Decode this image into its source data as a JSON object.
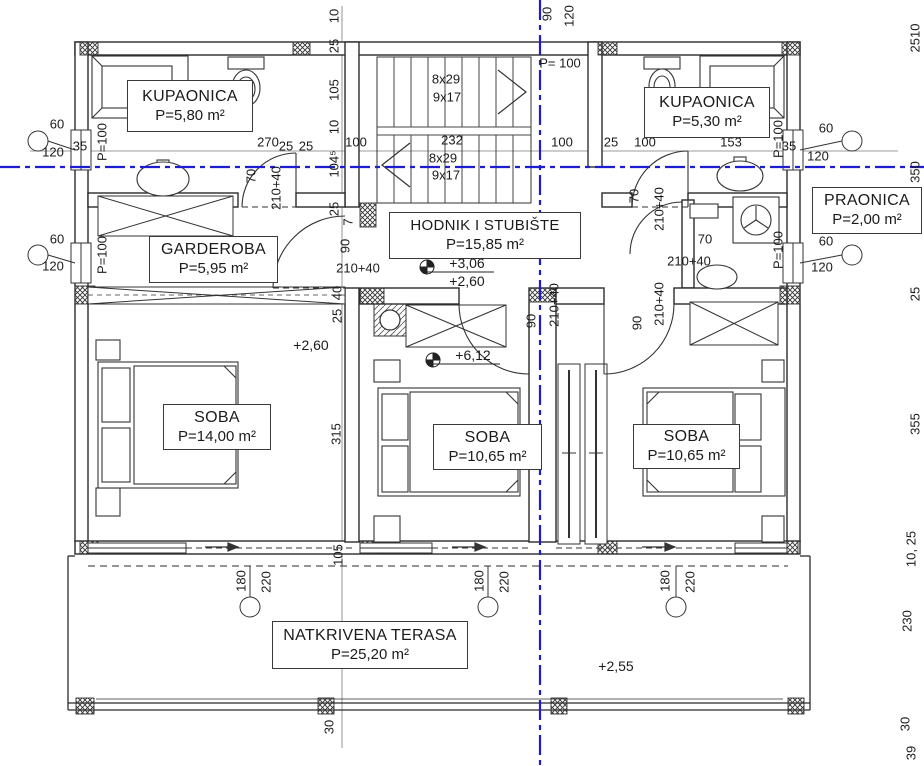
{
  "rooms": {
    "kupaonica_left": {
      "name": "KUPAONICA",
      "area": "P=5,80 m²"
    },
    "kupaonica_right": {
      "name": "KUPAONICA",
      "area": "P=5,30 m²"
    },
    "praonica": {
      "name": "PRAONICA",
      "area": "P=2,00 m²"
    },
    "garderoba": {
      "name": "GARDEROBA",
      "area": "P=5,95 m²"
    },
    "hodnik": {
      "name": "HODNIK I STUBIŠTE",
      "area": "P=15,85 m²"
    },
    "soba_left": {
      "name": "SOBA",
      "area": "P=14,00 m²"
    },
    "soba_middle": {
      "name": "SOBA",
      "area": "P=10,65 m²"
    },
    "soba_right": {
      "name": "SOBA",
      "area": "P=10,65 m²"
    },
    "terasa": {
      "name": "NATKRIVENA TERASA",
      "area": "P=25,20 m²"
    }
  },
  "levels": {
    "hall_upper": "+3,06",
    "hall_lower": "+2,60",
    "stair_top": "+6,12",
    "room_left": "+2,60",
    "terrace": "+2,55"
  },
  "stairs": {
    "upper_l1": "8x29",
    "upper_l2": "9x17",
    "lower_l1": "8x29",
    "lower_l2": "9x17"
  },
  "axis_color": "#1c1cd0",
  "dims": [
    {
      "t": "60",
      "x": 57,
      "y": 124,
      "r": 0
    },
    {
      "t": "120",
      "x": 53,
      "y": 152,
      "r": 0
    },
    {
      "t": "35",
      "x": 80,
      "y": 146,
      "r": 0
    },
    {
      "t": "270",
      "x": 268,
      "y": 142,
      "r": 0
    },
    {
      "t": "25",
      "x": 286,
      "y": 146,
      "r": 0
    },
    {
      "t": "25",
      "x": 306,
      "y": 146,
      "r": 0
    },
    {
      "t": "100",
      "x": 356,
      "y": 142,
      "r": 0
    },
    {
      "t": "232",
      "x": 452,
      "y": 140,
      "r": 0
    },
    {
      "t": "100",
      "x": 562,
      "y": 142,
      "r": 0
    },
    {
      "t": "25",
      "x": 611,
      "y": 142,
      "r": 0
    },
    {
      "t": "100",
      "x": 645,
      "y": 142,
      "r": 0
    },
    {
      "t": "153",
      "x": 731,
      "y": 142,
      "r": 0
    },
    {
      "t": "35",
      "x": 789,
      "y": 146,
      "r": 0
    },
    {
      "t": "120",
      "x": 818,
      "y": 156,
      "r": 0
    },
    {
      "t": "60",
      "x": 826,
      "y": 128,
      "r": 0
    },
    {
      "t": "60",
      "x": 57,
      "y": 239,
      "r": 0
    },
    {
      "t": "120",
      "x": 53,
      "y": 266,
      "r": 0
    },
    {
      "t": "60",
      "x": 826,
      "y": 241,
      "r": 0
    },
    {
      "t": "120",
      "x": 822,
      "y": 267,
      "r": 0
    },
    {
      "t": "10",
      "x": 334,
      "y": 16,
      "r": 1
    },
    {
      "t": "25",
      "x": 334,
      "y": 46,
      "r": 1
    },
    {
      "t": "105",
      "x": 334,
      "y": 90,
      "r": 1
    },
    {
      "t": "10",
      "x": 334,
      "y": 127,
      "r": 1
    },
    {
      "t": "104⁵",
      "x": 334,
      "y": 164,
      "r": 1
    },
    {
      "t": "25",
      "x": 334,
      "y": 209,
      "r": 1
    },
    {
      "t": "7",
      "x": 348,
      "y": 222,
      "r": 1
    },
    {
      "t": "90",
      "x": 547,
      "y": 14,
      "r": 1
    },
    {
      "t": "120",
      "x": 569,
      "y": 16,
      "r": 1
    },
    {
      "t": "P= 100",
      "x": 560,
      "y": 63,
      "r": 0
    },
    {
      "t": "P=100",
      "x": 102,
      "y": 142,
      "r": 1
    },
    {
      "t": "P=100",
      "x": 102,
      "y": 255,
      "r": 1
    },
    {
      "t": "P=100",
      "x": 778,
      "y": 139,
      "r": 1
    },
    {
      "t": "P=100",
      "x": 778,
      "y": 250,
      "r": 1
    },
    {
      "t": "70",
      "x": 251,
      "y": 176,
      "r": 1
    },
    {
      "t": "210+40",
      "x": 276,
      "y": 188,
      "r": 1
    },
    {
      "t": "70",
      "x": 634,
      "y": 196,
      "r": 1
    },
    {
      "t": "210+40",
      "x": 659,
      "y": 209,
      "r": 1
    },
    {
      "t": "70",
      "x": 705,
      "y": 239,
      "r": 0
    },
    {
      "t": "210+40",
      "x": 689,
      "y": 261,
      "r": 0
    },
    {
      "t": "90",
      "x": 345,
      "y": 246,
      "r": 1
    },
    {
      "t": "210+40",
      "x": 358,
      "y": 268,
      "r": 0
    },
    {
      "t": "40",
      "x": 337,
      "y": 293,
      "r": 1
    },
    {
      "t": "25",
      "x": 337,
      "y": 316,
      "r": 1
    },
    {
      "t": "90",
      "x": 531,
      "y": 321,
      "r": 1
    },
    {
      "t": "210+40",
      "x": 554,
      "y": 305,
      "r": 1
    },
    {
      "t": "90",
      "x": 637,
      "y": 323,
      "r": 1
    },
    {
      "t": "210+40",
      "x": 659,
      "y": 304,
      "r": 1
    },
    {
      "t": "315",
      "x": 336,
      "y": 434,
      "r": 1
    },
    {
      "t": "105",
      "x": 338,
      "y": 555,
      "r": 1
    },
    {
      "t": "180",
      "x": 241,
      "y": 581,
      "r": 1
    },
    {
      "t": "220",
      "x": 266,
      "y": 582,
      "r": 1
    },
    {
      "t": "180",
      "x": 479,
      "y": 581,
      "r": 1
    },
    {
      "t": "220",
      "x": 504,
      "y": 582,
      "r": 1
    },
    {
      "t": "180",
      "x": 665,
      "y": 581,
      "r": 1
    },
    {
      "t": "220",
      "x": 690,
      "y": 582,
      "r": 1
    },
    {
      "t": "230",
      "x": 330,
      "y": 647,
      "r": 1
    },
    {
      "t": "30",
      "x": 329,
      "y": 727,
      "r": 1
    },
    {
      "t": "2510",
      "x": 915,
      "y": 38,
      "r": 1
    },
    {
      "t": "350",
      "x": 915,
      "y": 172,
      "r": 1
    },
    {
      "t": "25",
      "x": 915,
      "y": 294,
      "r": 1
    },
    {
      "t": "355",
      "x": 915,
      "y": 424,
      "r": 1
    },
    {
      "t": "10, 25",
      "x": 911,
      "y": 549,
      "r": 1
    },
    {
      "t": "230",
      "x": 907,
      "y": 621,
      "r": 1
    },
    {
      "t": "30",
      "x": 905,
      "y": 724,
      "r": 1
    },
    {
      "t": "39",
      "x": 911,
      "y": 753,
      "r": 1
    }
  ]
}
